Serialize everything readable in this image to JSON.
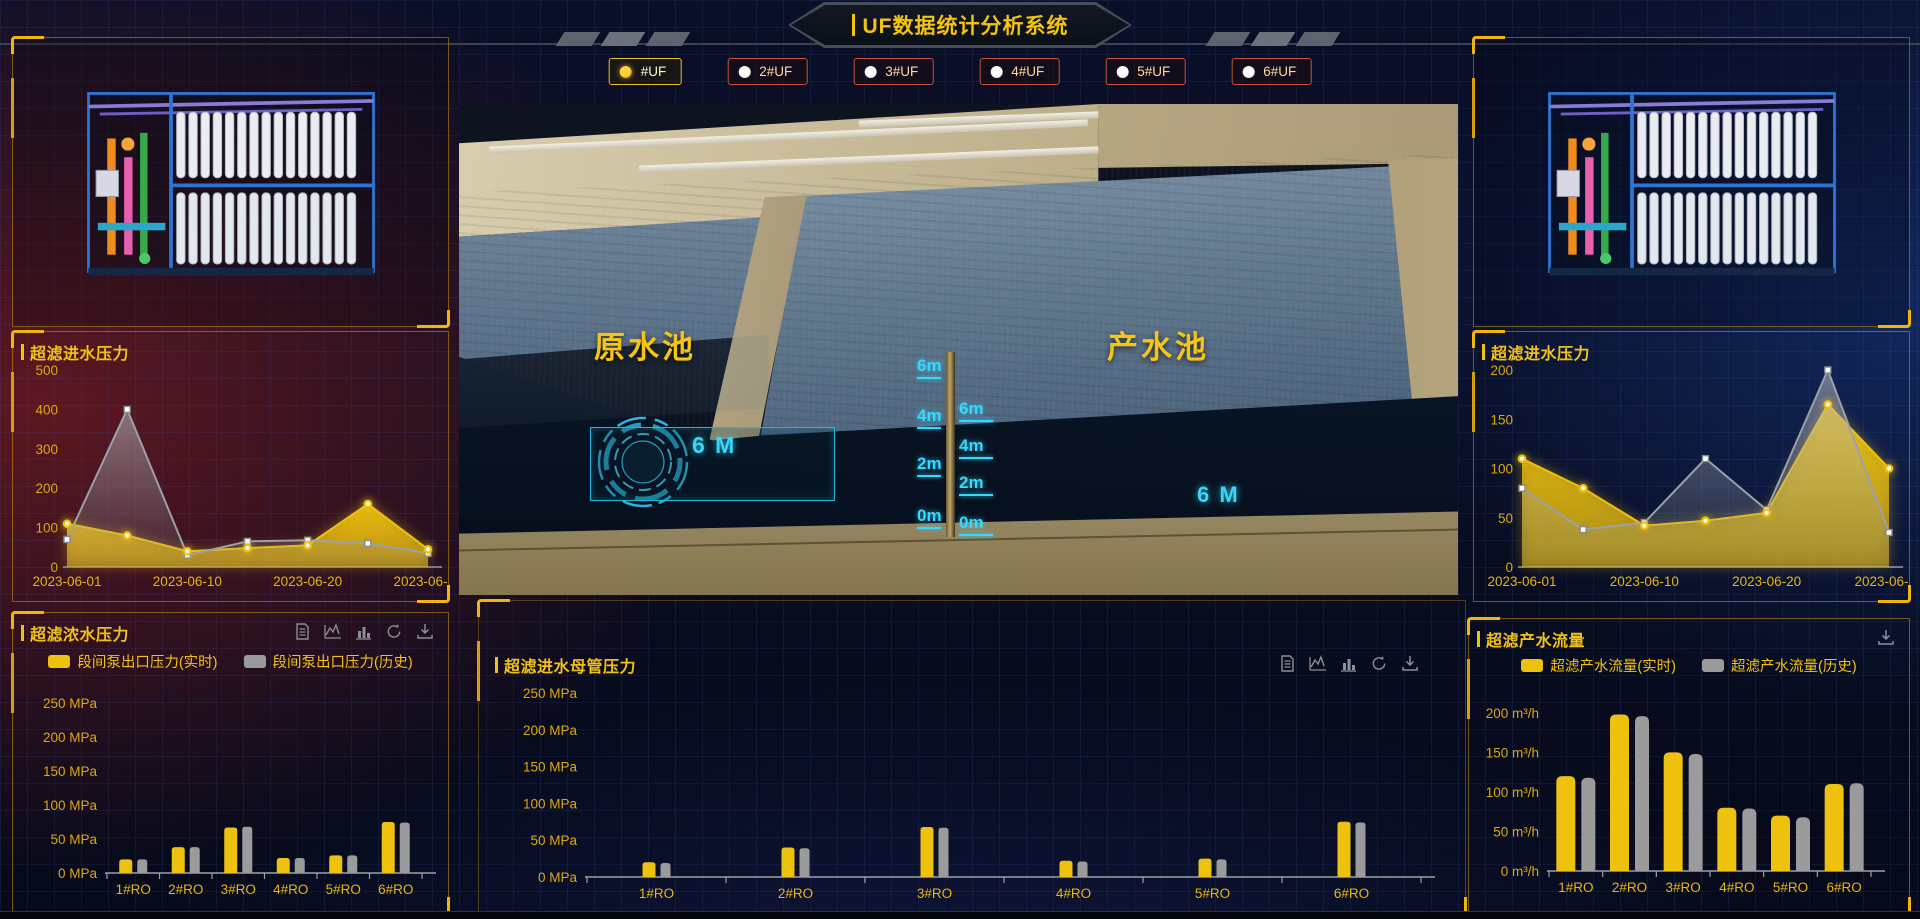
{
  "header": {
    "title": "UF数据统计分析系统",
    "uf_tabs": [
      {
        "label": "#UF",
        "selected": true
      },
      {
        "label": "2#UF",
        "selected": false
      },
      {
        "label": "3#UF",
        "selected": false
      },
      {
        "label": "4#UF",
        "selected": false
      },
      {
        "label": "5#UF",
        "selected": false
      },
      {
        "label": "6#UF",
        "selected": false
      }
    ]
  },
  "scene": {
    "raw_pool_label": "原水池",
    "product_pool_label": "产水池",
    "raw_pool_level_text": "6 M",
    "product_pool_level_text": "6 M",
    "level_scale_left": [
      "6m",
      "4m",
      "2m",
      "0m"
    ],
    "level_scale_right": [
      "6m",
      "4m",
      "2m",
      "0m"
    ]
  },
  "colors": {
    "accent_yellow": "#eec10e",
    "series_gray": "#9b9b9b",
    "hud_cyan": "#35d8ff",
    "axis_text": "#dca812"
  },
  "chart_data": [
    {
      "id": "uf-inlet-pressure-left",
      "type": "area",
      "title": "超滤进水压力",
      "x_labels": [
        "2023-06-01",
        "",
        "2023-06-10",
        "",
        "2023-06-20",
        "",
        "2023-06-30"
      ],
      "ylim": [
        0,
        500
      ],
      "ytick_values": [
        0,
        100,
        200,
        300,
        400,
        500
      ],
      "ytick_labels": [
        "0",
        "100",
        "200",
        "300",
        "400",
        "500"
      ],
      "series": [
        {
          "color": "#eec10e",
          "kind": "realtime",
          "values": [
            110,
            80,
            40,
            48,
            55,
            160,
            45
          ]
        },
        {
          "color": "#9ba1a8",
          "kind": "history",
          "values": [
            70,
            400,
            30,
            65,
            68,
            60,
            35
          ]
        }
      ]
    },
    {
      "id": "uf-inlet-pressure-right",
      "type": "area",
      "title": "超滤进水压力",
      "x_labels": [
        "2023-06-01",
        "",
        "2023-06-10",
        "",
        "2023-06-20",
        "",
        "2023-06-30"
      ],
      "ylim": [
        0,
        200
      ],
      "ytick_values": [
        0,
        50,
        100,
        150,
        200
      ],
      "ytick_labels": [
        "0",
        "50",
        "100",
        "150",
        "200"
      ],
      "series": [
        {
          "color": "#eec10e",
          "kind": "realtime",
          "values": [
            110,
            80,
            42,
            47,
            55,
            165,
            100
          ]
        },
        {
          "color": "#9ba1a8",
          "kind": "history",
          "values": [
            80,
            38,
            45,
            110,
            58,
            200,
            35
          ]
        }
      ]
    },
    {
      "id": "uf-concentrate-pressure",
      "type": "bar",
      "title": "超滤浓水压力",
      "categories": [
        "1#RO",
        "2#RO",
        "3#RO",
        "4#RO",
        "5#RO",
        "6#RO"
      ],
      "ylim": [
        0,
        250
      ],
      "ytick_values": [
        0,
        50,
        100,
        150,
        200,
        250
      ],
      "ytick_labels": [
        "0 MPa",
        "50 MPa",
        "100 MPa",
        "150 MPa",
        "200 MPa",
        "250 MPa"
      ],
      "legend": [
        "段间泵出口压力(实时)",
        "段间泵出口压力(历史)"
      ],
      "toolbox": [
        "data-view-icon",
        "line-chart-icon",
        "bar-chart-icon",
        "restore-icon",
        "download-icon"
      ],
      "series": [
        {
          "name": "段间泵出口压力(实时)",
          "color": "#eec10e",
          "values": [
            20,
            38,
            67,
            22,
            26,
            75
          ]
        },
        {
          "name": "段间泵出口压力(历史)",
          "color": "#9b9b9b",
          "values": [
            20,
            38,
            68,
            22,
            26,
            74
          ]
        }
      ]
    },
    {
      "id": "uf-inlet-header-pressure",
      "type": "bar",
      "title": "超滤进水母管压力",
      "categories": [
        "1#RO",
        "2#RO",
        "3#RO",
        "4#RO",
        "5#RO",
        "6#RO"
      ],
      "ylim": [
        0,
        250
      ],
      "ytick_values": [
        0,
        50,
        100,
        150,
        200,
        250
      ],
      "ytick_labels": [
        "0 MPa",
        "50 MPa",
        "100 MPa",
        "150 MPa",
        "200 MPa",
        "250 MPa"
      ],
      "legend": [],
      "toolbox": [
        "data-view-icon",
        "line-chart-icon",
        "bar-chart-icon",
        "restore-icon",
        "download-icon"
      ],
      "series": [
        {
          "name": "实时",
          "color": "#eec10e",
          "values": [
            20,
            40,
            68,
            22,
            25,
            75
          ]
        },
        {
          "name": "历史",
          "color": "#9b9b9b",
          "values": [
            19,
            39,
            67,
            21,
            24,
            74
          ]
        }
      ]
    },
    {
      "id": "uf-product-flow",
      "type": "bar",
      "title": "超滤产水流量",
      "categories": [
        "1#RO",
        "2#RO",
        "3#RO",
        "4#RO",
        "5#RO",
        "6#RO"
      ],
      "ylim": [
        0,
        210
      ],
      "ytick_values": [
        0,
        50,
        100,
        150,
        200
      ],
      "ytick_labels": [
        "0 m³/h",
        "50 m³/h",
        "100 m³/h",
        "150 m³/h",
        "200 m³/h"
      ],
      "legend": [
        "超滤产水流量(实时)",
        "超滤产水流量(历史)"
      ],
      "toolbox": [
        "download-icon"
      ],
      "series": [
        {
          "name": "超滤产水流量(实时)",
          "color": "#eec10e",
          "values": [
            120,
            198,
            150,
            80,
            70,
            110
          ]
        },
        {
          "name": "超滤产水流量(历史)",
          "color": "#9b9b9b",
          "values": [
            118,
            196,
            148,
            79,
            68,
            111
          ]
        }
      ]
    }
  ]
}
